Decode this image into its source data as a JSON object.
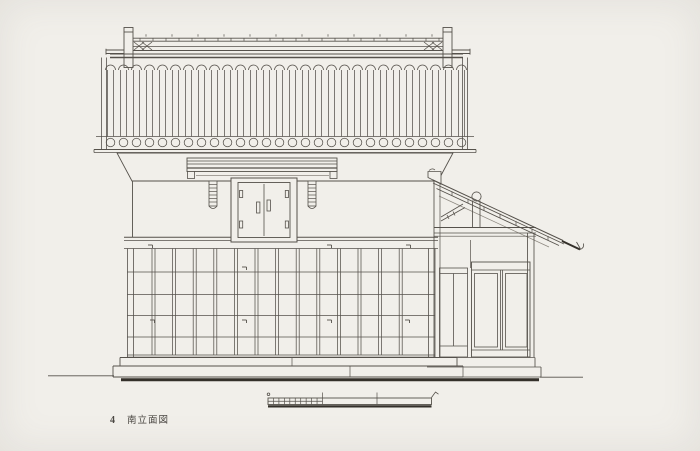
{
  "figure": {
    "number": "4",
    "caption": "南立面図"
  },
  "palette": {
    "paper": "#f1efea",
    "ink": "#55514b",
    "ink_light": "#8b867e",
    "ink_heavy": "#34302a"
  },
  "scale_bar": {
    "units": 3,
    "subdivisions_first_unit": 10,
    "unit": "m"
  },
  "patterns": {
    "roof_ribs": {
      "x0": 110.5,
      "period": 13,
      "count": 28,
      "half_w": 3,
      "top": 70,
      "bottom": 136.5,
      "scallop_r": 5,
      "circle_r": 4.3,
      "circle_cy": 142.5
    },
    "ridge_ticks": {
      "x0": 140,
      "period": 13,
      "count": 24,
      "y1": 38.2,
      "y2": 41.2
    },
    "ridge_dashes": {
      "x0": 146,
      "period": 26,
      "count": 12,
      "y1": 34.2,
      "y2": 36.6
    },
    "wall_battens": {
      "x0": 153.5,
      "period": 20.6,
      "count": 13,
      "top": 248.5,
      "bottom": 355,
      "gap": 3
    },
    "wall_rails": {
      "ys": [
        272,
        294.5,
        315.5,
        337,
        355
      ],
      "x1": 127,
      "x2": 435
    },
    "wall_hooks": [
      [
        148,
        245
      ],
      [
        327,
        245
      ],
      [
        406,
        245
      ],
      [
        242,
        267
      ],
      [
        150,
        320
      ],
      [
        242,
        320
      ],
      [
        327,
        320
      ],
      [
        405,
        320
      ]
    ],
    "corbels": {
      "rung_ys": [
        184.5,
        188,
        191.5,
        195,
        198.5,
        202
      ],
      "xs": [
        [
          209,
          217
        ],
        [
          308,
          316
        ]
      ]
    },
    "leanto_ticks": {
      "x0": 452,
      "period": 16,
      "count": 7,
      "base_x": 433,
      "base_y": 180,
      "slope": 0.4654
    },
    "scale": {
      "x0": 268,
      "unit_px": 54.5,
      "units": 3,
      "sub": 10,
      "top": 398,
      "bottom": 404.5
    }
  }
}
